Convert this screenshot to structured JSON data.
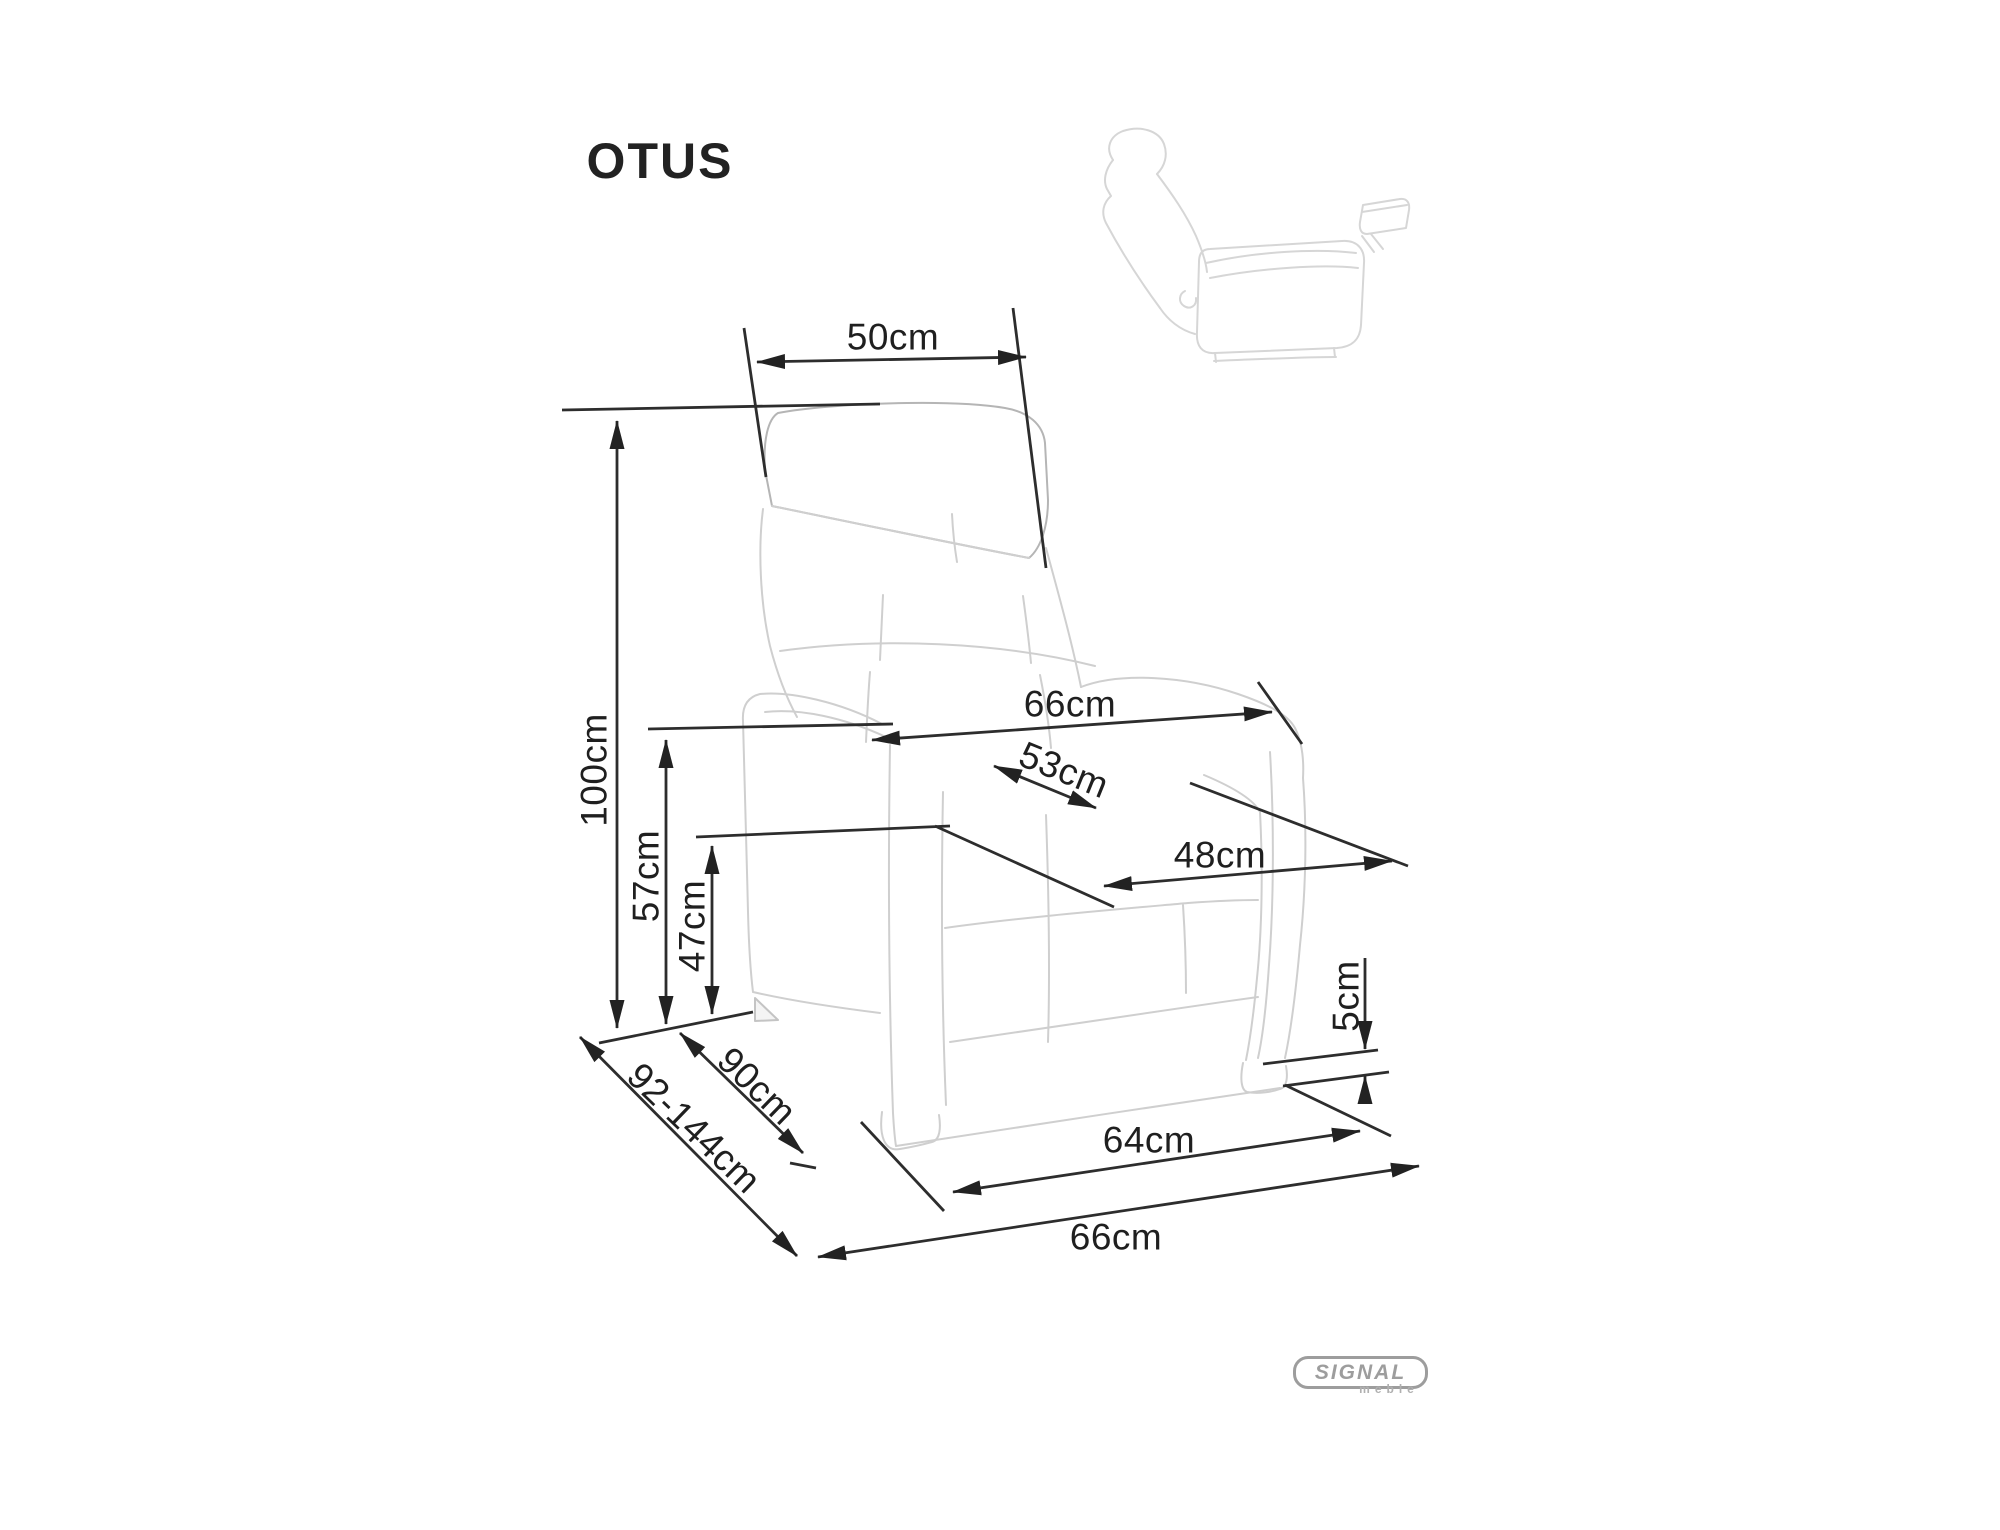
{
  "title": "OTUS",
  "dimensions": {
    "d50": "50cm",
    "d100": "100cm",
    "d66_upper": "66cm",
    "d53": "53cm",
    "d48": "48cm",
    "d57": "57cm",
    "d47": "47cm",
    "d90": "90cm",
    "d92_144": "92-144cm",
    "d5": "5cm",
    "d64": "64cm",
    "d66_lower": "66cm"
  },
  "logo": {
    "brand": "SIGNAL",
    "subtext": "meble"
  },
  "colors": {
    "background": "#ffffff",
    "dimension_lines": "#2d2d2d",
    "sketch_lines": "#cfcfcf",
    "logo_gray": "#9d9d9d"
  }
}
